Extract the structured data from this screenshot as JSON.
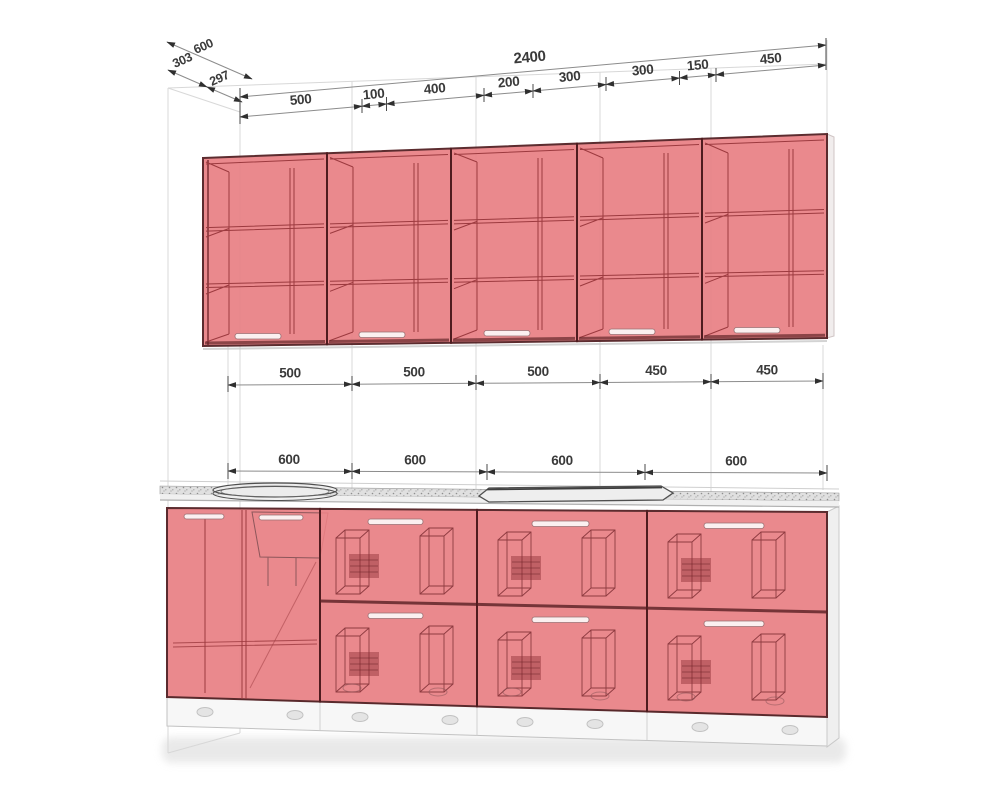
{
  "drawing": {
    "depth_chain": {
      "total": "600",
      "seg1": "303",
      "seg2": "297"
    },
    "top_chain": {
      "total": "2400",
      "segments": [
        "500",
        "100",
        "400",
        "200",
        "300",
        "300",
        "150",
        "450"
      ]
    },
    "wall_cabinet_widths": [
      "500",
      "500",
      "500",
      "450",
      "450"
    ],
    "base_cabinet_widths": [
      "600",
      "600",
      "600",
      "600"
    ],
    "colors": {
      "cabinet_fill": "#e98084",
      "cabinet_outline": "#4f1b1e",
      "dimension_text": "#3a3a3a",
      "countertop": "#e0e0e0",
      "wall_line": "#d8d8d8"
    }
  }
}
